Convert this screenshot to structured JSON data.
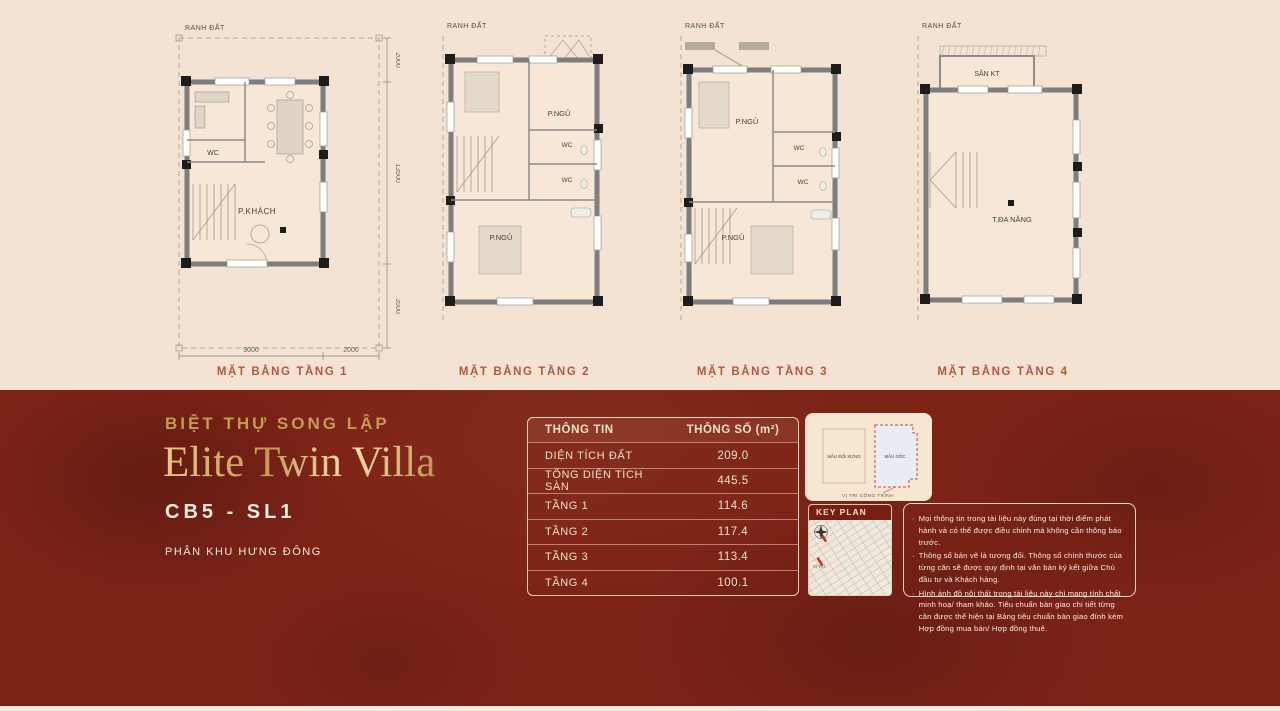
{
  "colors": {
    "background_top": "#f4e3d2",
    "background_bottom": "#7d2316",
    "gold": "#c9a05c",
    "cream_text": "#f2e2c4",
    "plan_label_color": "#b2583e",
    "keyplan_bar": "#771e10",
    "highlight_red": "#c0392b"
  },
  "plans": [
    {
      "label": "MẶT BẰNG TẦNG 1",
      "boundary_label": "RANH ĐẤT",
      "rooms": {
        "wc": "WC",
        "living": "P.KHÁCH"
      },
      "dims": {
        "front": "2000",
        "depth": "13500",
        "rear": "3500",
        "width": "9000",
        "side": "2000"
      }
    },
    {
      "label": "MẶT BẰNG TẦNG 2",
      "boundary_label": "RANH ĐẤT",
      "rooms": {
        "bed1": "P.NGỦ",
        "wc1": "WC",
        "wc2": "WC",
        "bed2": "P.NGỦ"
      }
    },
    {
      "label": "MẶT BẰNG TẦNG 3",
      "boundary_label": "RANH ĐẤT",
      "rooms": {
        "bed1": "P.NGỦ",
        "wc1": "WC",
        "wc2": "WC",
        "bed2": "P.NGỦ"
      }
    },
    {
      "label": "MẶT BẰNG TẦNG 4",
      "boundary_label": "RANH ĐẤT",
      "rooms": {
        "yard": "SÂN KT",
        "multi": "T.ĐA NĂNG"
      }
    }
  ],
  "info": {
    "category": "BIỆT THỰ SONG LẬP",
    "name": "Elite Twin Villa",
    "code": "CB5 - SL1",
    "zone": "PHÂN KHU HƯNG ĐÔNG"
  },
  "table": {
    "headers": [
      "THÔNG TIN",
      "THÔNG SỐ (m²)"
    ],
    "rows": [
      {
        "label": "DIỆN TÍCH ĐẤT",
        "value": "209.0"
      },
      {
        "label": "TỔNG DIỆN TÍCH SÀN",
        "value": "445.5"
      },
      {
        "label": "TẦNG 1",
        "value": "114.6"
      },
      {
        "label": "TẦNG 2",
        "value": "117.4"
      },
      {
        "label": "TẦNG 3",
        "value": "113.4"
      },
      {
        "label": "TẦNG 4",
        "value": "100.1"
      }
    ]
  },
  "variant_card": {
    "left_label": "MẪU ĐỐI XỨNG",
    "right_label": "MẪU GỐC",
    "caption": "VỊ TRÍ CÔNG TRÌNH"
  },
  "key_plan": {
    "title": "KEY PLAN",
    "location_label": "VỊ TRÍ"
  },
  "disclaimer": {
    "bullets": [
      "Mọi thông tin trong tài liệu này đúng tại thời điểm phát hành và có thể được điều chỉnh mà không cần thông báo trước.",
      "Thông số bản vẽ là tương đối. Thông số chính thước của từng căn sẽ được quy định tại văn bản ký kết giữa Chủ đầu tư và Khách hàng.",
      "Hình ảnh đồ nội thất trong tài liệu này chỉ mang tính chất minh hoạ/ tham khảo. Tiêu chuẩn bàn giao chi tiết từng căn được thể hiện tại Bảng tiêu chuẩn bàn giao đính kèm Hợp đồng mua bán/ Hợp đồng thuê."
    ]
  }
}
